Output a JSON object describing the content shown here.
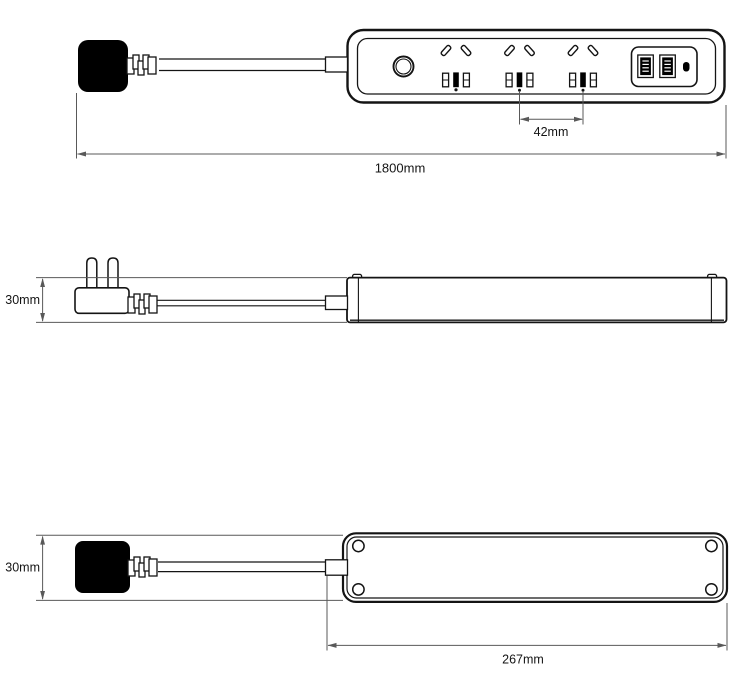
{
  "diagram": {
    "type": "technical-drawing",
    "subject": "power strip with 3 outlets, 2 USB-A ports, 1 USB-C port and power button",
    "views": {
      "top": {
        "name": "top-view",
        "dim_outlet_spacing": "42mm",
        "dim_total_length": "1800mm"
      },
      "side": {
        "name": "side-view",
        "dim_height": "30mm"
      },
      "bottom": {
        "name": "bottom-view",
        "dim_width": "30mm",
        "dim_body_length": "267mm"
      }
    },
    "colors": {
      "outline": "#141414",
      "dimension": "#595959",
      "plug_fill": "#000000",
      "background": "#ffffff"
    }
  }
}
